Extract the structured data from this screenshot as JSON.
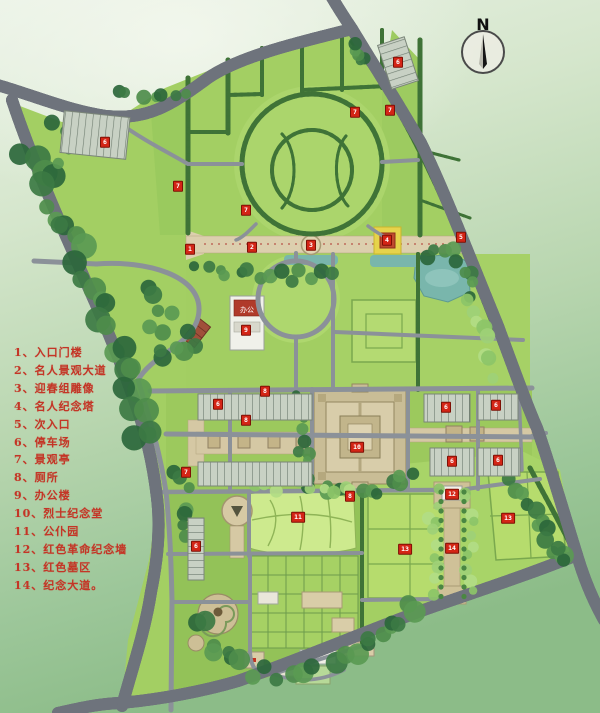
{
  "map": {
    "compass_label": "N",
    "legend": {
      "items": [
        "1、入口门楼",
        "2、名人景观大道",
        "3、迎春组雕像",
        "4、名人纪念塔",
        "5、次入口",
        "6、停车场",
        "7、景观亭",
        "8、厕所",
        "9、办公楼",
        "10、烈士纪念堂",
        "11、公仆园",
        "12、红色革命纪念墙",
        "13、红色墓区",
        "14、纪念大道。"
      ]
    },
    "office_building_label": "办公",
    "markers": [
      {
        "label": "1",
        "x": 190,
        "y": 249
      },
      {
        "label": "2",
        "x": 252,
        "y": 247
      },
      {
        "label": "3",
        "x": 311,
        "y": 245
      },
      {
        "label": "4",
        "x": 387,
        "y": 240
      },
      {
        "label": "5",
        "x": 461,
        "y": 237
      },
      {
        "label": "6",
        "x": 105,
        "y": 142
      },
      {
        "label": "6",
        "x": 398,
        "y": 62
      },
      {
        "label": "6",
        "x": 218,
        "y": 404
      },
      {
        "label": "6",
        "x": 446,
        "y": 407
      },
      {
        "label": "6",
        "x": 496,
        "y": 405
      },
      {
        "label": "6",
        "x": 452,
        "y": 461
      },
      {
        "label": "6",
        "x": 498,
        "y": 460
      },
      {
        "label": "6",
        "x": 196,
        "y": 546
      },
      {
        "label": "7",
        "x": 355,
        "y": 112
      },
      {
        "label": "7",
        "x": 390,
        "y": 110
      },
      {
        "label": "7",
        "x": 178,
        "y": 186
      },
      {
        "label": "7",
        "x": 246,
        "y": 210
      },
      {
        "label": "7",
        "x": 186,
        "y": 472
      },
      {
        "label": "8",
        "x": 265,
        "y": 391
      },
      {
        "label": "8",
        "x": 246,
        "y": 420
      },
      {
        "label": "8",
        "x": 350,
        "y": 496
      },
      {
        "label": "9",
        "x": 246,
        "y": 330
      },
      {
        "label": "10",
        "x": 357,
        "y": 447
      },
      {
        "label": "11",
        "x": 298,
        "y": 517
      },
      {
        "label": "12",
        "x": 452,
        "y": 494
      },
      {
        "label": "13",
        "x": 405,
        "y": 549
      },
      {
        "label": "13",
        "x": 508,
        "y": 518
      },
      {
        "label": "14",
        "x": 452,
        "y": 548
      }
    ],
    "colors": {
      "background_top": "#eaf2e6",
      "background_bottom": "#8cbc88",
      "lawn": "#a3cf63",
      "road_fill": "#959ba5",
      "road_casing": "#6e737c",
      "boundary_dash": "#e23018",
      "hedge_green": "#3f7337",
      "forest_dark": "#2c683a",
      "water_teal": "#79b6ac",
      "paving_tan": "#d9cdae",
      "plaza_yellow": "#e6d34b",
      "building_red": "#bf4a2e",
      "marker_red": "#d42516",
      "legend_red": "#c43526"
    }
  }
}
